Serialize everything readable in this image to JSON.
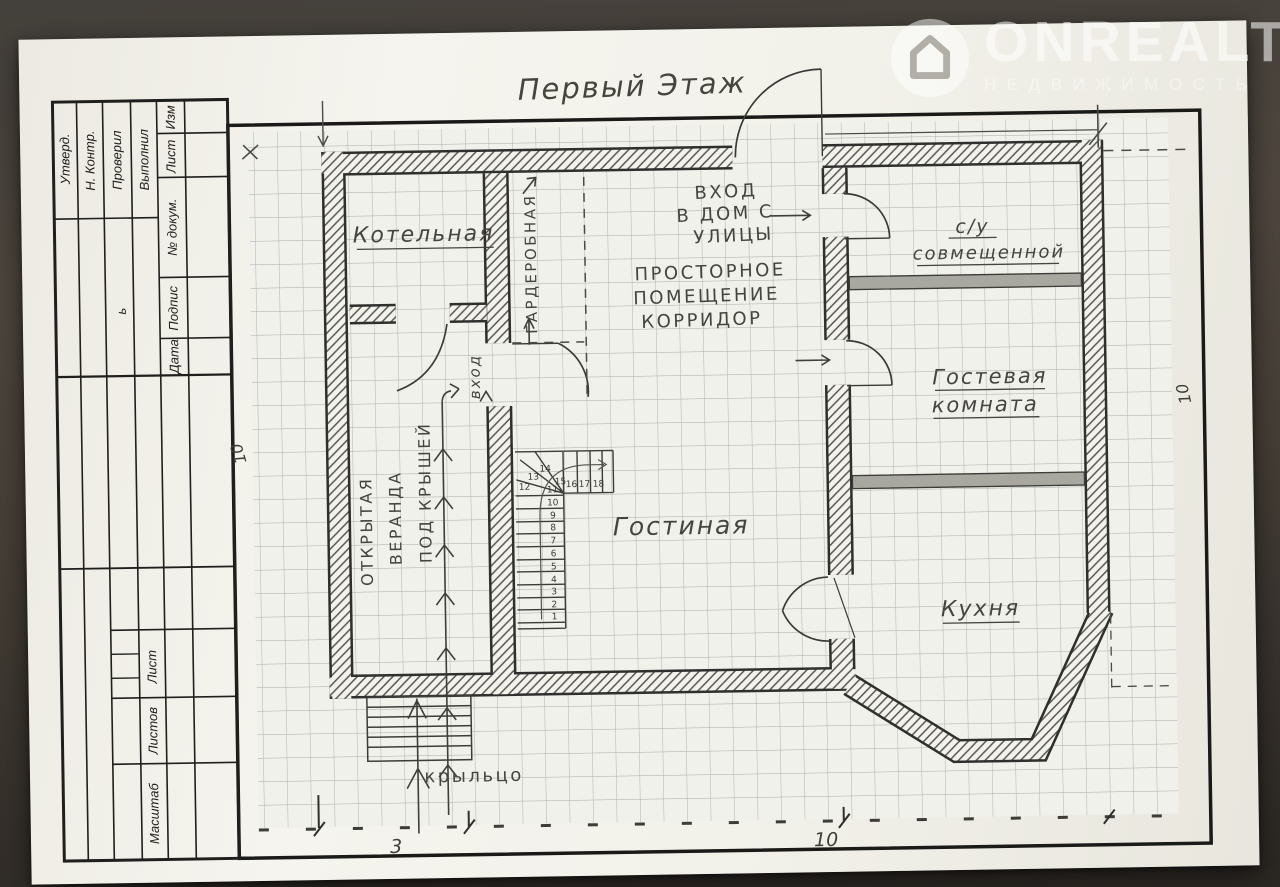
{
  "watermark": {
    "brand": "ONREALT",
    "subtitle": "НЕДВИЖИМОСТЬ"
  },
  "sheet_title": "Первый Этаж",
  "title_block": {
    "izm": "Изм",
    "list": "Лист",
    "doc_no": "№ докум.",
    "podpis": "Подпис",
    "podpis_tail": "ь",
    "data": "Дата",
    "vypolnil": "Выполнил",
    "proveril": "Проверил",
    "n_kontr": "Н. Контр.",
    "utverd": "Утверд.",
    "list_bottom": "Лист",
    "listov": "Листов",
    "masshtab": "Масштаб"
  },
  "rooms": {
    "boiler": "Котельная",
    "wardrobe": "ГАРДЕРОБНАЯ",
    "entry": "вход",
    "entrance_line1": "ВХОД",
    "entrance_line2": "В ДОМ С",
    "entrance_line3": "УЛИЦЫ",
    "hall_line1": "ПРОСТОРНОЕ",
    "hall_line2": "ПОМЕЩЕНИЕ",
    "hall_line3": "КОРРИДОР",
    "bath_line1": "с/у",
    "bath_line2": "совмещенной",
    "guest_line1": "Гостевая",
    "guest_line2": "комната",
    "living": "Гостиная",
    "kitchen": "Кухня",
    "veranda_line1": "ОТКРЫТАЯ",
    "veranda_line2": "ВЕРАНДА",
    "veranda_line3": "ПОД КРЫШЕЙ",
    "porch": "крыльцо"
  },
  "stairs": {
    "steps": [
      "1",
      "2",
      "3",
      "4",
      "5",
      "6",
      "7",
      "8",
      "9",
      "10",
      "11",
      "12",
      "13",
      "14",
      "15",
      "16",
      "17",
      "18"
    ]
  },
  "dimensions": {
    "bottom_span_left": "3",
    "bottom_span_right": "10",
    "left_height": "10",
    "right_height": "10"
  }
}
